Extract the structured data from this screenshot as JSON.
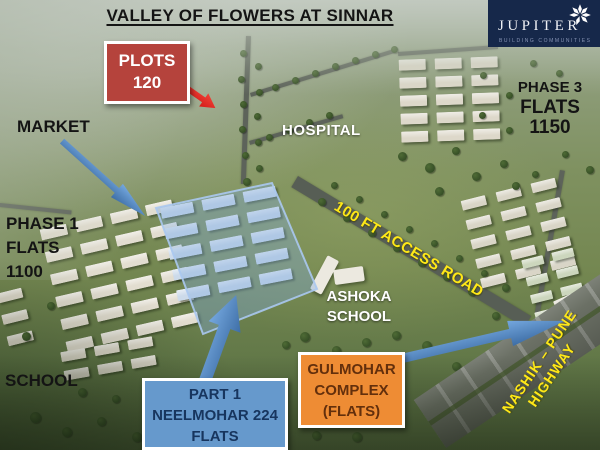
{
  "title": "VALLEY OF FLOWERS AT SINNAR",
  "logo": {
    "name": "JUPITER",
    "tagline": "BUILDING COMMUNITIES"
  },
  "labels": {
    "plots": {
      "line1": "PLOTS",
      "line2": "120"
    },
    "market": "MARKET",
    "hospital": "HOSPITAL",
    "phase3": {
      "line1": "PHASE 3",
      "line2": "FLATS",
      "line3": "1150"
    },
    "phase1": {
      "line1": "PHASE 1",
      "line2": "FLATS",
      "line3": "1100"
    },
    "access_road": "100 FT ACCESS ROAD",
    "ashoka": {
      "line1": "ASHOKA",
      "line2": "SCHOOL"
    },
    "school": "SCHOOL",
    "part1": {
      "line1": "PART 1",
      "line2": "NEELMOHAR",
      "line3": "224 FLATS"
    },
    "gulmohar": {
      "line1": "GULMOHAR",
      "line2": "COMPLEX",
      "line3": "(FLATS)"
    },
    "highway": {
      "line1": "NASHIK – PUNE",
      "line2": "HIGHWAY"
    }
  },
  "colors": {
    "plots-red": "#b5433c",
    "arrow-red": "#d41b18",
    "part1-blue": "#6699cc",
    "gulmohar-orange": "#ee8c34",
    "arrow-blue": "#3e6ea6",
    "road-yellow": "#ffe817",
    "logo-navy": "#16284a"
  }
}
